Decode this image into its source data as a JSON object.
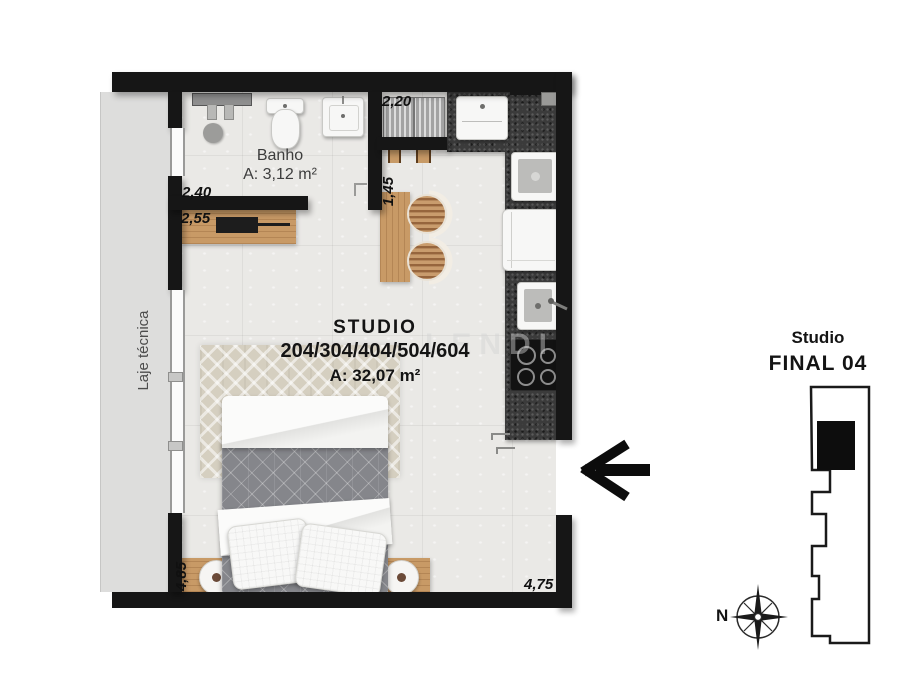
{
  "floor_plan": {
    "bathroom": {
      "name": "Banho",
      "area": "A: 3,12 m²"
    },
    "studio": {
      "name": "STUDIO",
      "units": "204/304/404/504/604",
      "area": "A: 32,07 m²"
    },
    "laje_label": "Laje técnica",
    "dimensions": {
      "bathroom_width": "2,40",
      "desk_width": "2,55",
      "service_width": "2,20",
      "counter_length": "1,45",
      "left_side": "4,85",
      "bottom_side": "4,75"
    }
  },
  "key_plan": {
    "title": "Studio",
    "subtitle": "FINAL 04"
  },
  "compass": {
    "north": "N"
  },
  "watermark": "LENDI",
  "colors": {
    "wall": "#161616",
    "floor": "#eae9e6",
    "laje": "#dddddc",
    "kitchen_counter": "#3b3b3b",
    "wood": "#c89a66",
    "duvet": "#85868b",
    "rug": "#d5cfc0"
  }
}
